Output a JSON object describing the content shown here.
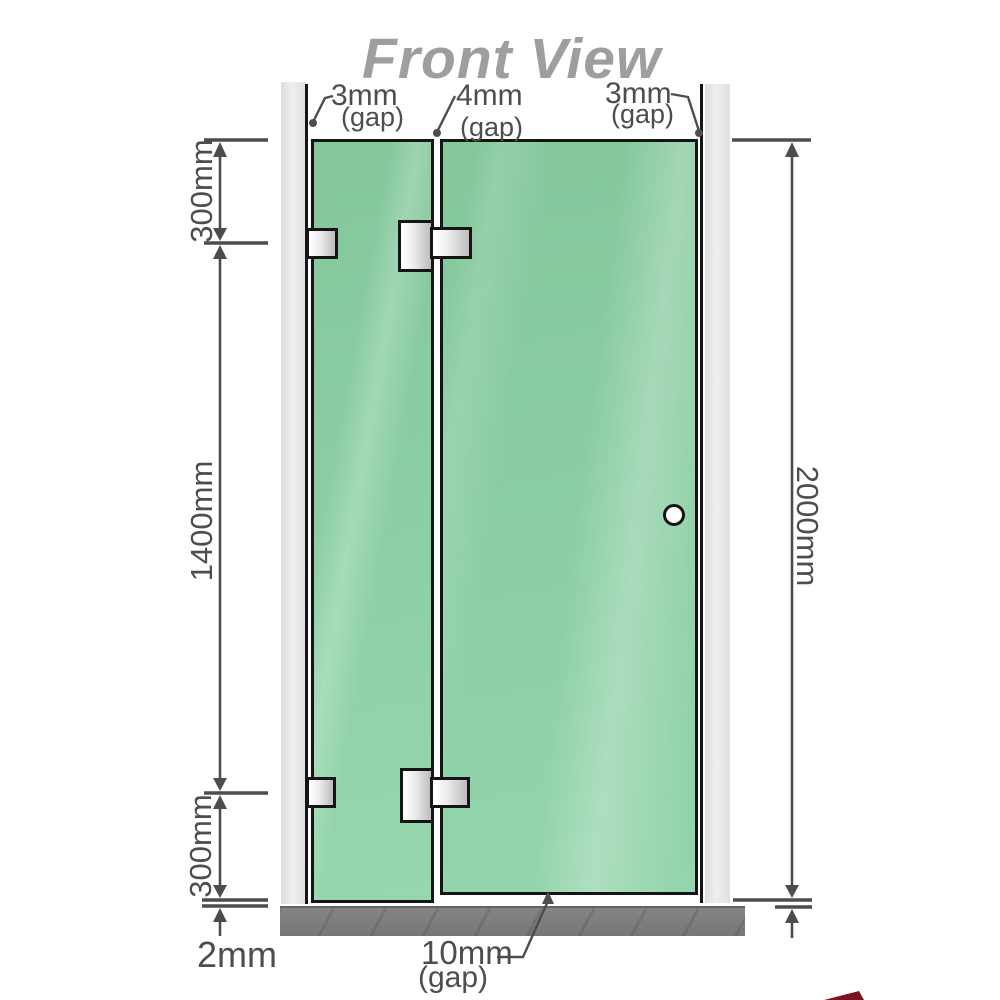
{
  "title": "Front View",
  "labels": {
    "gap_top_left_value": "3mm",
    "gap_top_left_unit": "(gap)",
    "gap_top_mid_value": "4mm",
    "gap_top_mid_unit": "(gap)",
    "gap_top_right_value": "3mm",
    "gap_top_right_unit": "(gap)",
    "dim_left_top": "300mm",
    "dim_left_middle": "1400mm",
    "dim_left_bottom": "300mm",
    "dim_floor_thickness": "2mm",
    "dim_right_total": "2000mm",
    "gap_bottom_value": "10mm",
    "gap_bottom_unit": "(gap)"
  },
  "colors": {
    "glass_green": "#8bcea4",
    "glass_green_dark": "#7ec29a",
    "glass_green_light": "#a4ddba",
    "channel_gray": "#e6e6e6",
    "floor_gray": "#7a7a7a",
    "metal_light": "#ffffff",
    "metal_dark": "#bfbfbf",
    "dimension_gray": "#4d4d4d",
    "title_gray": "#9e9e9e",
    "outline_black": "#151515",
    "logo_maroon": "#7a1322"
  }
}
